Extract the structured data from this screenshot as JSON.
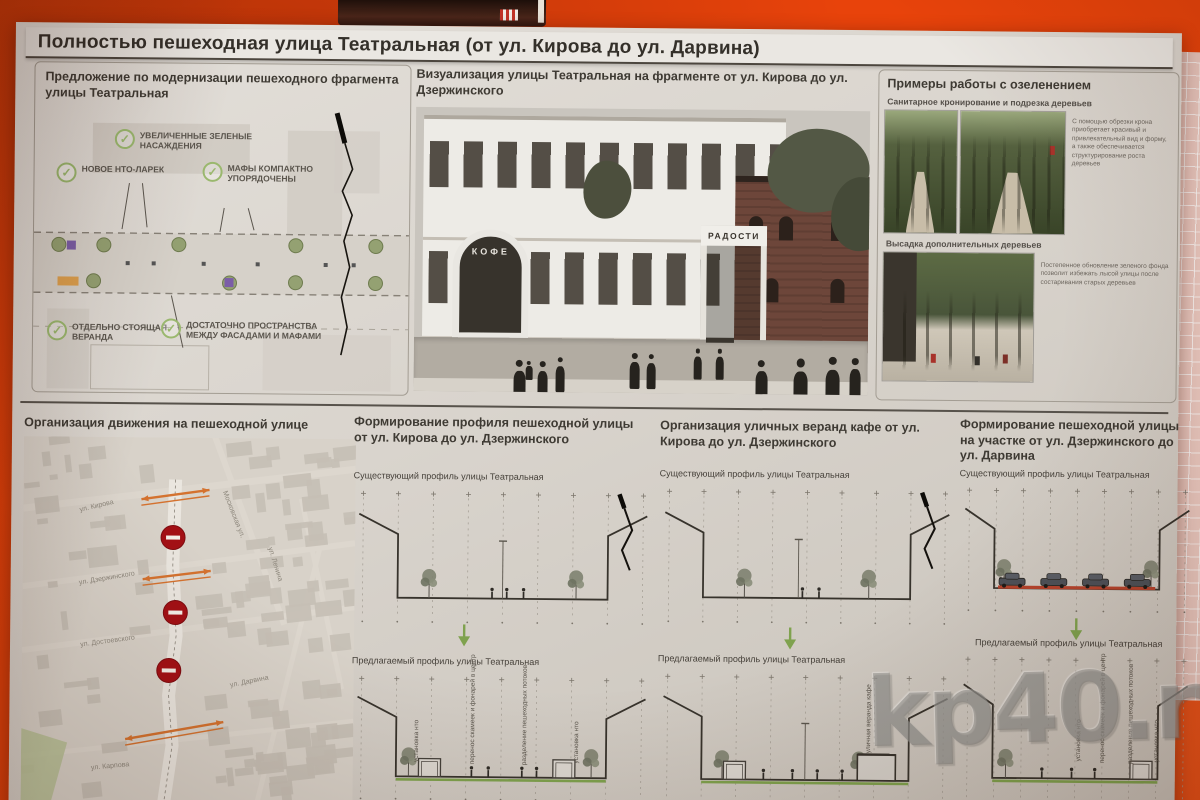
{
  "poster": {
    "title": "Полностью пешеходная улица Театральная (от ул. Кирова до ул. Дарвина)"
  },
  "proposal": {
    "heading": "Предложение по модернизации пешеходного фрагмента улицы Театральная",
    "check_icon": "✓",
    "checks": [
      {
        "label": "УВЕЛИЧЕННЫЕ ЗЕЛЕНЫЕ НАСАЖДЕНИЯ"
      },
      {
        "label": "НОВОЕ НТО-ЛАРЕК"
      },
      {
        "label": "МАФЫ КОМПАКТНО УПОРЯДОЧЕНЫ"
      },
      {
        "label": "ОТДЕЛЬНО СТОЯЩАЯ ВЕРАНДА"
      },
      {
        "label": "ДОСТАТОЧНО ПРОСТРАНСТВА МЕЖДУ ФАСАДАМИ И МАФАМИ"
      }
    ]
  },
  "visualization": {
    "heading": "Визуализация улицы Театральная на фрагменте от ул. Кирова до ул. Дзержинского",
    "signs": {
      "cafe": "КОФЕ",
      "radosti": "РАДОСТИ"
    }
  },
  "greening": {
    "heading": "Примеры работы с озеленением",
    "item1": {
      "caption": "Санитарное кронирование и подрезка деревьев",
      "note": "С помощью обрезки крона приобретает красивый и привлекательный вид и форму, а также обеспечивается структурирование роста деревьев"
    },
    "item2": {
      "caption": "Высадка дополнительных деревьев",
      "note": "Постепенное обновление зеленого фонда позволит избежать лысой улицы после состаривания старых деревьев"
    }
  },
  "traffic": {
    "heading": "Организация движения на пешеходной улице",
    "streets": [
      "ул. Кирова",
      "Московская ул.",
      "ул. Ленина",
      "ул. Дзержинского",
      "ул. Достоевского",
      "ул. Дарвина",
      "ул. Карпова"
    ]
  },
  "profile_kirova": {
    "heading": "Формирование профиля пешеходной улицы от ул. Кирова до ул. Дзержинского",
    "existing_caption": "Существующий профиль улицы Театральная",
    "proposed_caption": "Предлагаемый профиль улицы Театральная",
    "annotations": [
      "установка нто",
      "перенос скамеек и фонарей в центр",
      "разделение пешеходных потоков",
      "установка нто"
    ]
  },
  "verandas": {
    "heading": "Организация уличных веранд кафе от ул. Кирова до ул. Дзержинского",
    "existing_caption": "Существующий профиль улицы Театральная",
    "proposed_caption": "Предлагаемый профиль улицы Театральная",
    "annotations": [
      "уличная веранда кафе"
    ]
  },
  "profile_darvina": {
    "heading": "Формирование пешеходной улицы на участке от ул. Дзержинского до ул. Дарвина",
    "existing_caption": "Существующий профиль улицы Театральная",
    "proposed_caption": "Предлагаемый профиль улицы Театральная",
    "annotations": [
      "установка нто",
      "перенос скамеек и фонарей в центр",
      "разделение пешеходных потоков",
      "установка нто"
    ]
  },
  "watermark": "kp40.ru",
  "palette": {
    "bg-orange": "#e8430b",
    "mat-pink": "#eccac1",
    "paper": "#d9d4cd",
    "ink": "#3a362f",
    "check-green": "#9ab86e",
    "map-red": "#a31015",
    "arrow-orange": "#d4722f",
    "profile-green": "#7fa24e"
  }
}
